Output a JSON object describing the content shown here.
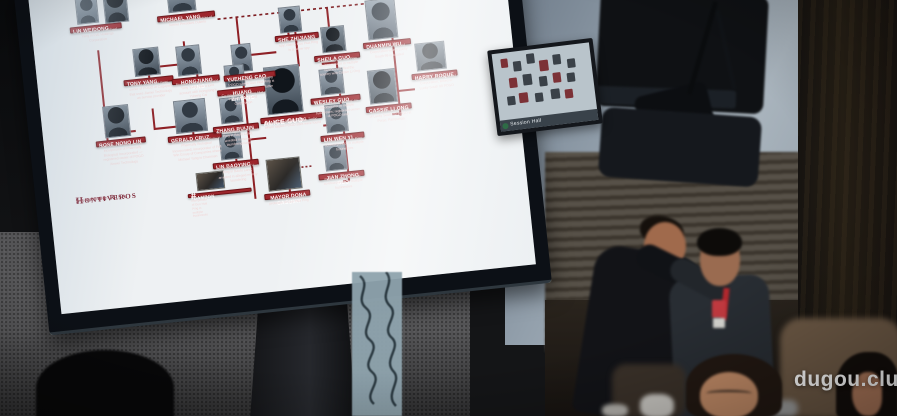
{
  "scene": {
    "watermark": "dugou.club",
    "mini_screen_caption": "Session Hall"
  },
  "presentation": {
    "branding": {
      "line1": "Senator Risa",
      "line2": "Hontiveros",
      "tagline": "Senate of the Philippines"
    },
    "nodes": [
      {
        "id": "lin-weidong",
        "name": "LIN WEIDONG",
        "subname": "",
        "desc": "Co-incorporator of Michael Yang in FvE Holdings Corporation"
      },
      {
        "id": "michael-yang",
        "name": "MICHAEL YANG",
        "subname": "",
        "desc": "Presidential economic adviser of former President Duterte"
      },
      {
        "id": "yueheng-cao",
        "name": "YUEHENG CAO",
        "subname": "",
        "desc": "Co-incorporator of Hongjiang POGO where Guo Hua Ping is its authorized representative"
      },
      {
        "id": "she-zhijiang",
        "name": "SHE ZHIJIANG",
        "subname": "",
        "desc": "Self-confessed Chinese spy; claims Guo Hua Ping is a fellow spy"
      },
      {
        "id": "sheila-guo",
        "name": "SHEILA GUO",
        "subname": "",
        "desc": "\"Sister\" of Guo Hua Ping; co-incorporator in multiple businesses; fled the country with Cassie Li Ong"
      },
      {
        "id": "duanmin-wu",
        "name": "DUANMIN WU",
        "subname": "",
        "desc": "Treasurer of Whirlwind Corporation where Lucky South 99 is located"
      },
      {
        "id": "harry-roque",
        "name": "HARRY ROQUE",
        "subname": "",
        "desc": "Legal counsel of Whirlwind Corporation; linked to Lucky South 99 POGO"
      },
      {
        "id": "tony-yang",
        "name": "TONY YANG",
        "subname": "",
        "desc": "Brother of Michael Yang; owner of POGO in Cagayan that uses Jiamei Technology as service provider"
      },
      {
        "id": "hongjiang-yang",
        "name": "HONGJIANG YANG",
        "subname": "",
        "desc": "Brother of Michael Yang and Tony Yang; has a joint account with Hongjiang's Yuheng Cai"
      },
      {
        "id": "huang-zhiyang",
        "name": "HUANG ZHIYANG",
        "subname": "",
        "desc": "Co-incorporator of Guo Hua Ping in Baofu Land Corporation"
      },
      {
        "id": "alice-guo",
        "name": "ALICE GUO",
        "subname": "AKA GUO HUA PING",
        "desc": "Former mayor of Bamban, Tarlac where raided POGO sites were found"
      },
      {
        "id": "wesley-guo",
        "name": "WESLEY GUO",
        "subname": "",
        "desc": "Brother of Guo Hua Ping; co-incorporator in multiple businesses; registered owner of POGO land"
      },
      {
        "id": "cassie-li-ong",
        "name": "CASSIE LI ONG",
        "subname": "",
        "desc": "Authorized representative of Lucky South 99 POGO in Porac, Pampanga"
      },
      {
        "id": "rose-nono-lin",
        "name": "ROSE NONO LIN",
        "subname": "",
        "desc": "Wife of Lin Weidong and co-incorporator of Pharmally Biological Incorporated — registered owner of POGO Xinwei Technology"
      },
      {
        "id": "gerald-cruz",
        "name": "GERALD CRUZ",
        "subname": "",
        "desc": "Co-incorporator of Rose Nono in Pharmally Biological Incorporated; incorporator of Full Win Group of Companies where Michael Yang is Chairman"
      },
      {
        "id": "zhang-ruijin",
        "name": "ZHANG RUIJIN",
        "subname": "",
        "desc": "Co-incorporator of Guo Hua Ping in Baofu Land; arrested in money laundering case"
      },
      {
        "id": "lin-baoying",
        "name": "LIN BAOYING",
        "subname": "",
        "desc": "Co-incorporator of Guo Hua Ping in Baofu Land; arrested in alleged money laundering"
      },
      {
        "id": "mayor-dona-caguiay",
        "name": "MAYOR DONA CAGUIAY",
        "subname": "",
        "desc": "Sual Mayor, alleged protector of Guo Hua Ping"
      },
      {
        "id": "lin-wen-yi",
        "name": "LIN WEN YI",
        "subname": "",
        "desc": "Mother of Guo Hua Ping; co-incorporator in multiple businesses"
      },
      {
        "id": "jian-zhong-guo",
        "name": "JIAN ZHONG GUO",
        "subname": "",
        "desc": "Father of Guo Hua Ping; co-incorporator in multiple businesses"
      },
      {
        "id": "bambon-banner",
        "name": "#BAMBON",
        "subname": "",
        "desc": "Co-incorporator of Guo Hua Ping in multiple businesses"
      }
    ]
  }
}
